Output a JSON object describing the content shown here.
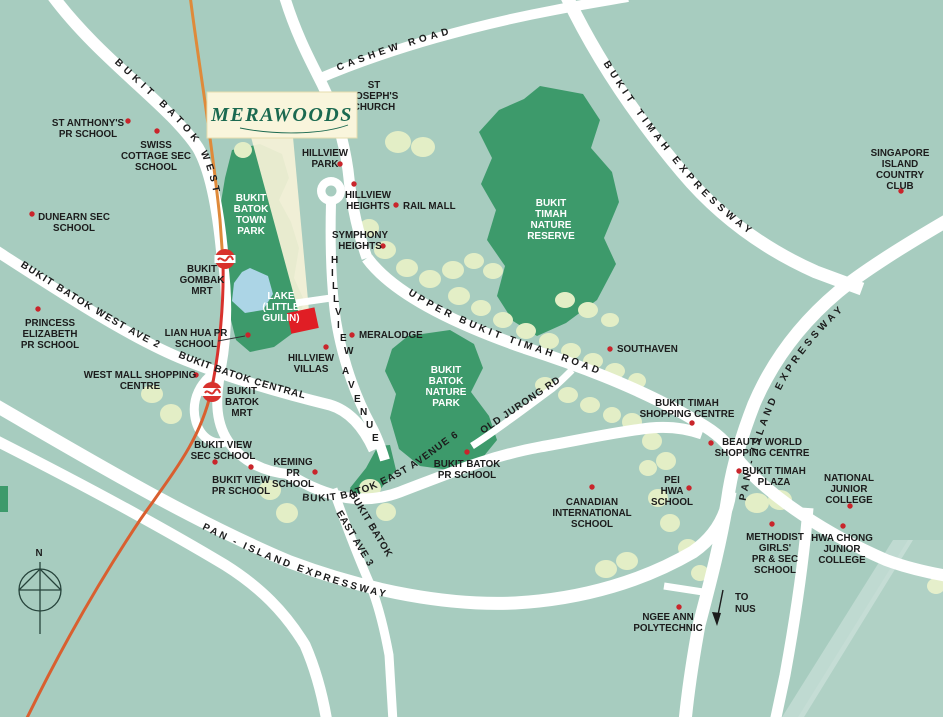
{
  "map": {
    "logo": {
      "text": "MERAWOODS"
    },
    "compass": {
      "label": "N"
    },
    "colors": {
      "background": "#A7CCBF",
      "park_green": "#3D9A6B",
      "tree_green": "#E3EEC6",
      "road_white": "#FFFFFF",
      "lake_blue": "#ACD5E6",
      "rail_orange": "#DF8A3A",
      "rail_red": "#D8322D",
      "marker_red": "#C9252B",
      "site_red": "#E01E25",
      "logo_cream": "#F9F5DC",
      "logo_green": "#1B6950"
    },
    "roads": {
      "bukit_batok_west": "BUKIT BATOK WEST",
      "cashew_road": "CASHEW ROAD",
      "bukit_timah_expressway": "BUKIT TIMAH EXPRESSWAY",
      "pan_island_expressway_right": "PAN - ISLAND EXPRESSWAY",
      "pan_island_expressway_bottom": "PAN - ISLAND EXPRESSWAY",
      "upper_bukit_timah_road": "UPPER BUKIT TIMAH ROAD",
      "old_jurong_rd": "OLD JURONG RD",
      "bukit_batok_west_ave_2": "BUKIT BATOK WEST AVE 2",
      "bukit_batok_central": "BUKIT BATOK CENTRAL",
      "bukit_batok_east_avenue_6": "BUKIT BATOK EAST AVENUE 6",
      "bukit_batok_east_ave_3_line1": "BUKIT BATOK",
      "bukit_batok_east_ave_3_line2": "EAST AVE 3",
      "hillview_avenue": "HILLVIEW AVENUE"
    },
    "parks": {
      "town_park": {
        "lines": [
          "BUKIT",
          "BATOK",
          "TOWN",
          "PARK"
        ]
      },
      "lake": {
        "lines": [
          "LAKE",
          "(LITTLE",
          "GUILIN)"
        ]
      },
      "nature_reserve": {
        "lines": [
          "BUKIT",
          "TIMAH",
          "NATURE",
          "RESERVE"
        ]
      },
      "nature_park": {
        "lines": [
          "BUKIT",
          "BATOK",
          "NATURE",
          "PARK"
        ]
      }
    },
    "mrt": {
      "bukit_gombak": {
        "lines": [
          "BUKIT",
          "GOMBAK",
          "MRT"
        ]
      },
      "bukit_batok": {
        "lines": [
          "BUKIT",
          "BATOK",
          "MRT"
        ]
      }
    },
    "places": [
      {
        "id": "st-anthonys-pr-school",
        "lines": [
          "ST ANTHONY'S",
          "PR SCHOOL"
        ]
      },
      {
        "id": "swiss-cottage-sec-school",
        "lines": [
          "SWISS",
          "COTTAGE SEC",
          "SCHOOL"
        ]
      },
      {
        "id": "dunearn-sec-school",
        "lines": [
          "DUNEARN SEC",
          "SCHOOL"
        ]
      },
      {
        "id": "st-josephs-church",
        "lines": [
          "ST",
          "JOSEPH'S",
          "CHURCH"
        ]
      },
      {
        "id": "hillview-park",
        "lines": [
          "HILLVIEW",
          "PARK"
        ]
      },
      {
        "id": "hillview-heights",
        "lines": [
          "HILLVIEW",
          "HEIGHTS"
        ]
      },
      {
        "id": "rail-mall",
        "lines": [
          "RAIL MALL"
        ]
      },
      {
        "id": "symphony-heights",
        "lines": [
          "SYMPHONY",
          "HEIGHTS"
        ]
      },
      {
        "id": "singapore-island-country-club",
        "lines": [
          "SINGAPORE",
          "ISLAND",
          "COUNTRY",
          "CLUB"
        ]
      },
      {
        "id": "princess-elizabeth-pr-school",
        "lines": [
          "PRINCESS",
          "ELIZABETH",
          "PR SCHOOL"
        ]
      },
      {
        "id": "lian-hua-pr-school",
        "lines": [
          "LIAN HUA PR",
          "SCHOOL"
        ]
      },
      {
        "id": "west-mall-shopping-centre",
        "lines": [
          "WEST MALL SHOPPING",
          "CENTRE"
        ]
      },
      {
        "id": "southaven",
        "lines": [
          "SOUTHAVEN"
        ]
      },
      {
        "id": "meralodge",
        "lines": [
          "MERALODGE"
        ]
      },
      {
        "id": "hillview-villas",
        "lines": [
          "HILLVIEW",
          "VILLAS"
        ]
      },
      {
        "id": "bukit-timah-shopping-centre",
        "lines": [
          "BUKIT TIMAH",
          "SHOPPING CENTRE"
        ]
      },
      {
        "id": "beauty-world-shopping-centre",
        "lines": [
          "BEAUTY WORLD",
          "SHOPPING CENTRE"
        ]
      },
      {
        "id": "bukit-timah-plaza",
        "lines": [
          "BUKIT TIMAH",
          "PLAZA"
        ]
      },
      {
        "id": "pei-hwa-school",
        "lines": [
          "PEI",
          "HWA",
          "SCHOOL"
        ]
      },
      {
        "id": "national-junior-college",
        "lines": [
          "NATIONAL",
          "JUNIOR",
          "COLLEGE"
        ]
      },
      {
        "id": "hwa-chong-junior-college",
        "lines": [
          "HWA CHONG",
          "JUNIOR",
          "COLLEGE"
        ]
      },
      {
        "id": "methodist-girls-school",
        "lines": [
          "METHODIST",
          "GIRLS'",
          "PR & SEC",
          "SCHOOL"
        ]
      },
      {
        "id": "bukit-view-sec-school",
        "lines": [
          "BUKIT VIEW",
          "SEC SCHOOL"
        ]
      },
      {
        "id": "bukit-view-pr-school",
        "lines": [
          "BUKIT VIEW",
          "PR SCHOOL"
        ]
      },
      {
        "id": "keming-pr-school",
        "lines": [
          "KEMING",
          "PR",
          "SCHOOL"
        ]
      },
      {
        "id": "bukit-batok-pr-school",
        "lines": [
          "BUKIT BATOK",
          "PR SCHOOL"
        ]
      },
      {
        "id": "canadian-international-school",
        "lines": [
          "CANADIAN",
          "INTERNATIONAL",
          "SCHOOL"
        ]
      },
      {
        "id": "ngee-ann-polytechnic",
        "lines": [
          "NGEE ANN",
          "POLYTECHNIC"
        ]
      }
    ],
    "annotations": {
      "to_nus": {
        "lines": [
          "TO",
          "NUS"
        ]
      }
    }
  }
}
